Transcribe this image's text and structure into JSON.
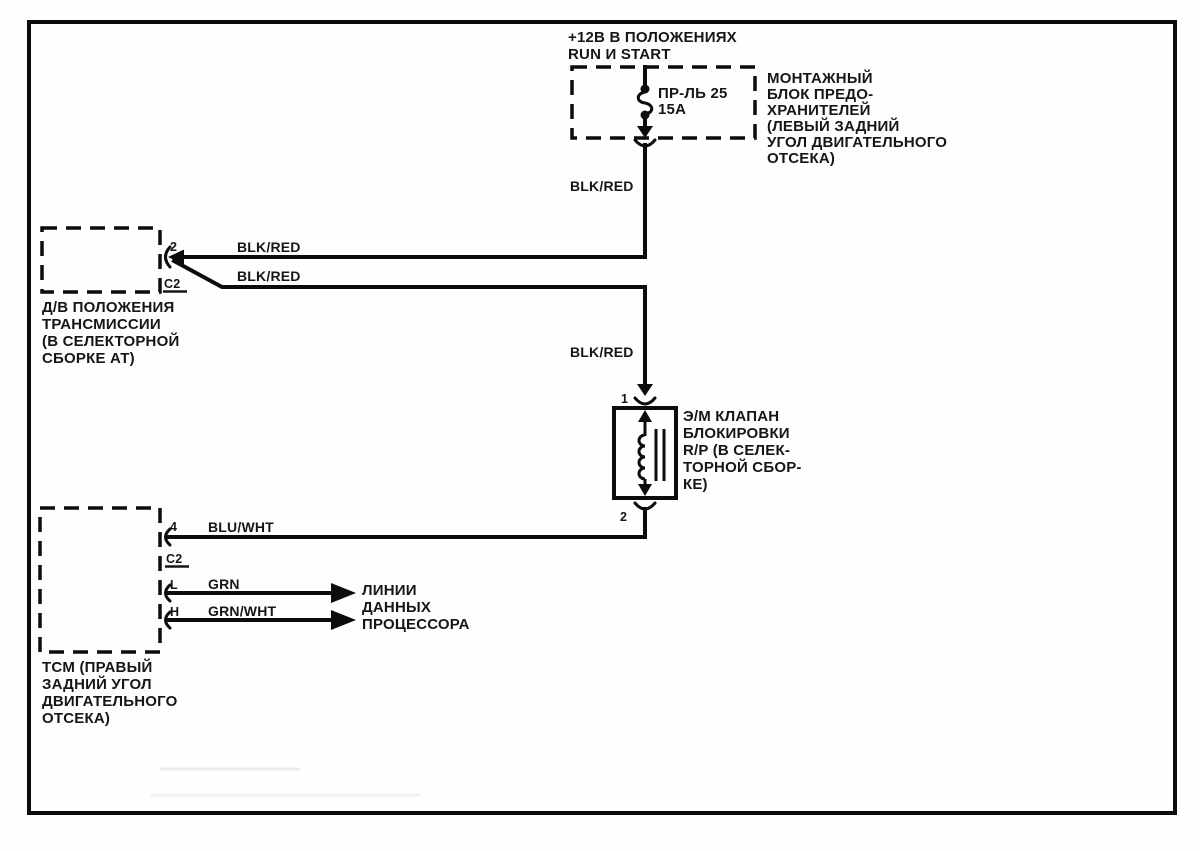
{
  "diagram": {
    "power_source": {
      "line1": "+12В В ПОЛОЖЕНИЯХ",
      "line2": "RUN И START"
    },
    "fuse_block": {
      "fuse_name": "ПР-ЛЬ 25",
      "fuse_rating": "15А",
      "label_lines": [
        "МОНТАЖНЫЙ",
        "БЛОК ПРЕДО-",
        "ХРАНИТЕЛЕЙ",
        "(ЛЕВЫЙ ЗАДНИЙ",
        "УГОЛ ДВИГАТЕЛЬНОГО",
        "ОТСЕКА)"
      ]
    },
    "trans_switch": {
      "pin": "2",
      "connector": "C2",
      "label_lines": [
        "Д/В ПОЛОЖЕНИЯ",
        "ТРАНСМИССИИ",
        "(В СЕЛЕКТОРНОЙ",
        "СБОРКЕ АТ)"
      ]
    },
    "solenoid": {
      "pin_top": "1",
      "pin_bottom": "2",
      "label_lines": [
        "Э/М КЛАПАН",
        "БЛОКИРОВКИ",
        "R/P (В СЕЛЕК-",
        "ТОРНОЙ СБОР-",
        "КЕ)"
      ]
    },
    "tcm": {
      "pin4": "4",
      "connector": "C2",
      "pinL": "L",
      "pinH": "H",
      "label_lines": [
        "TCM (ПРАВЫЙ",
        "ЗАДНИЙ УГОЛ",
        "ДВИГАТЕЛЬНОГО",
        "ОТСЕКА)"
      ],
      "data_lines_label": [
        "ЛИНИИ",
        "ДАННЫХ",
        "ПРОЦЕССОРА"
      ]
    },
    "wire_labels": {
      "fuse_output": "BLK/RED",
      "switch_feed": "BLK/RED",
      "switch_output": "BLK/RED",
      "solenoid_feed": "BLK/RED",
      "solenoid_return": "BLU/WHT",
      "data_line_l": "GRN",
      "data_line_h": "GRN/WHT"
    },
    "colors": {
      "ink": "#161616",
      "line": "#0c0c0c",
      "background": "#fefefe"
    }
  }
}
